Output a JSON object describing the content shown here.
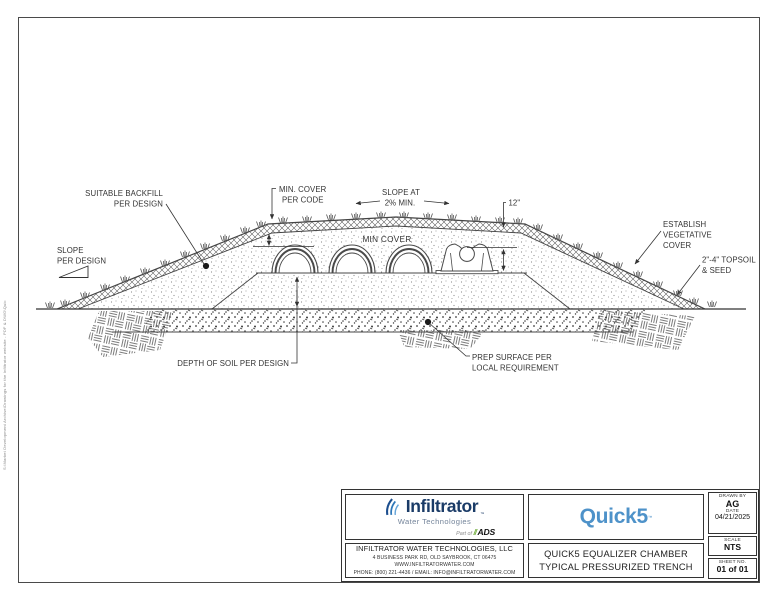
{
  "page": {
    "file_path": "S:\\Market Development Archive\\Drawings for the Infiltrator website - PDF & DWG\\Quick5 Equalizer 36 chamber\\Q5 EQ 36 TRENCH.dwg"
  },
  "drawing": {
    "labels": {
      "suitable_backfill": [
        "SUITABLE BACKFILL",
        "PER DESIGN"
      ],
      "slope_per_design": [
        "SLOPE",
        "PER DESIGN"
      ],
      "min_cover_code": [
        "MIN. COVER",
        "PER CODE"
      ],
      "slope_at": [
        "SLOPE AT",
        "2% MIN."
      ],
      "dim_12": "12\"",
      "min_cover": "MIN COVER",
      "establish": [
        "ESTABLISH",
        "VEGETATIVE",
        "COVER"
      ],
      "topsoil": [
        "2\"-4\" TOPSOIL",
        "& SEED"
      ],
      "depth_of_soil": "DEPTH OF SOIL PER DESIGN",
      "prep_surface": [
        "PREP SURFACE PER",
        "LOCAL REQUIREMENT"
      ]
    }
  },
  "title_block": {
    "logo": {
      "brand": "Infiltrator",
      "tm": "™",
      "sub": "Water Technologies",
      "part_of": "Part of",
      "slashes": "//",
      "ads": "ADS"
    },
    "product_logo": {
      "name": "Quick5",
      "tm": "™"
    },
    "company": {
      "name": "INFILTRATOR WATER TECHNOLOGIES, LLC",
      "address": "4 BUSINESS PARK RD, OLD SAYBROOK, CT 06475",
      "website": "WWW.INFILTRATORWATER.COM",
      "contact": "PHONE: (800) 221-4436 / EMAIL: INFO@INFILTRATORWATER.COM"
    },
    "drawing_title": [
      "QUICK5 EQUALIZER CHAMBER",
      "TYPICAL PRESSURIZED TRENCH"
    ],
    "meta": {
      "drawn_by_label": "DRAWN BY",
      "drawn_by": "AG",
      "date_label": "DATE",
      "date": "04/21/2025",
      "scale_label": "SCALE",
      "scale": "NTS",
      "sheet_label": "SHEET NO.",
      "sheet": "01 of 01"
    }
  },
  "colors": {
    "brand_navy": "#1a3b67",
    "brand_blue": "#2e77b8",
    "ads_green": "#76b043",
    "quick5_blue": "#4e92c9",
    "line": "#4a4a4a"
  }
}
